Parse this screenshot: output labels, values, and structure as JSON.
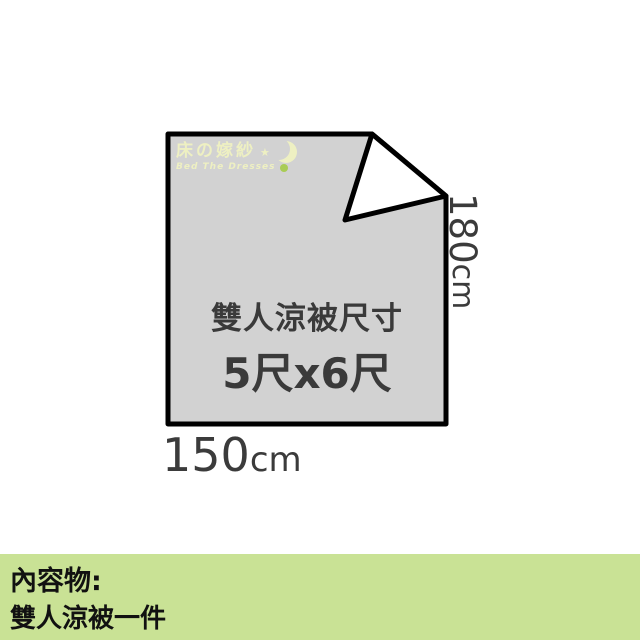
{
  "brand": {
    "name": "床の嫁紗",
    "star": "★",
    "tagline": "Bed The Dresses"
  },
  "quilt": {
    "title": "雙人涼被尺寸",
    "size": "5尺x6尺",
    "height_value": "180",
    "height_unit": "cm",
    "width_value": "150",
    "width_unit": "cm"
  },
  "footer": {
    "heading": "內容物:",
    "item": "雙人涼被一件"
  },
  "colors": {
    "quilt_fill": "#d2d2d2",
    "quilt_outline": "#000000",
    "fold_fill": "#ffffff",
    "footer_background": "#c9e295",
    "brand_text": "#eef0c2",
    "brand_dot": "#a9cc55",
    "dimension_text": "#3b3b3b"
  }
}
